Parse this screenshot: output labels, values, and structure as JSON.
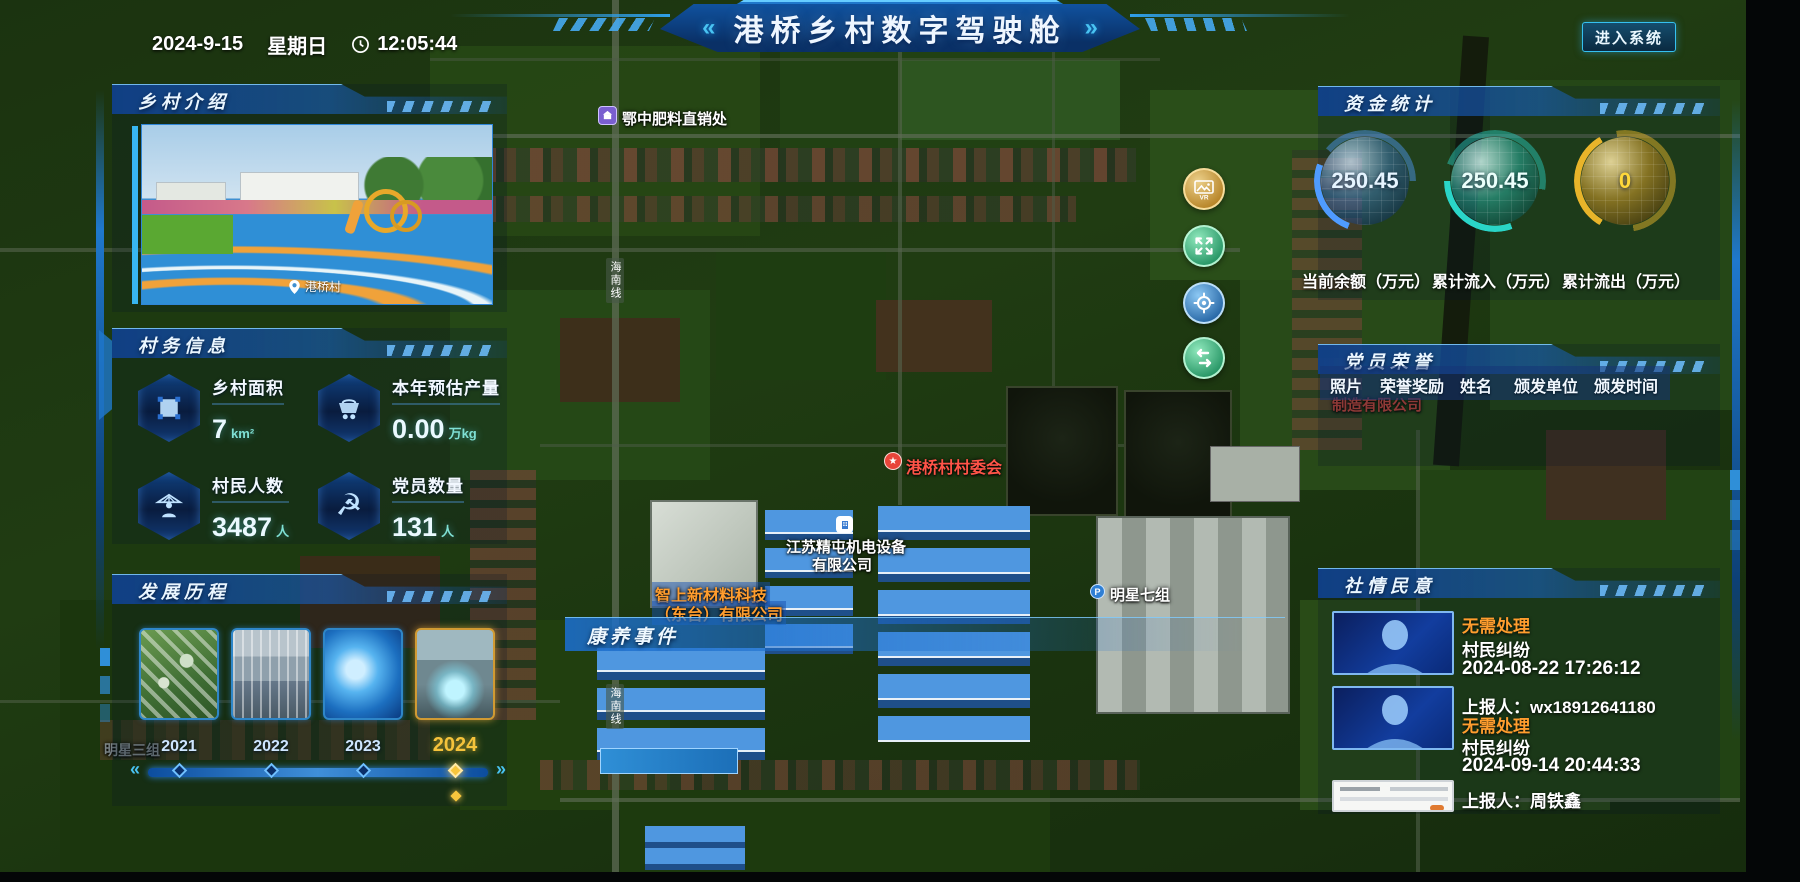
{
  "header": {
    "title": "港桥乡村数字驾驶舱",
    "left_quote": "«",
    "right_quote": "»",
    "date": "2024-9-15",
    "weekday": "星期日",
    "time": "12:05:44",
    "enter_button": "进入系统"
  },
  "panels": {
    "village_intro": {
      "title": "乡村介绍",
      "photo_caption": "港桥村"
    },
    "village_info": {
      "title": "村务信息",
      "stats": [
        {
          "icon": "area-icon",
          "label": "乡村面积",
          "value": "7",
          "unit": "km²"
        },
        {
          "icon": "cart-icon",
          "label": "本年预估产量",
          "value": "0.00",
          "unit": "万kg"
        },
        {
          "icon": "farmer-icon",
          "label": "村民人数",
          "value": "3487",
          "unit": "人"
        },
        {
          "icon": "party-icon",
          "label": "党员数量",
          "value": "131",
          "unit": "人"
        }
      ]
    },
    "development": {
      "title": "发展历程",
      "years": [
        "2021",
        "2022",
        "2023",
        "2024"
      ],
      "active_year": "2024",
      "slider_left_arrow": "«",
      "slider_right_arrow": "»"
    },
    "funds": {
      "title": "资金统计",
      "gauges": [
        {
          "value": "250.45",
          "label": "当前余额（万元）",
          "color": "#4f9bff"
        },
        {
          "value": "250.45",
          "label": "累计流入（万元）",
          "color": "#2ad5c8"
        },
        {
          "value": "0",
          "label": "累计流出（万元）",
          "color": "#e8b42a"
        }
      ]
    },
    "party_honor": {
      "title": "党员荣誉",
      "columns": [
        "照片",
        "荣誉奖励",
        "姓名",
        "颁发单位",
        "颁发时间"
      ]
    },
    "public_opinion": {
      "title": "社情民意",
      "items": [
        {
          "status": "无需处理",
          "type": "村民纠纷",
          "datetime": "2024-08-22 17:26:12",
          "reporter": "上报人：wx18912641180"
        },
        {
          "status": "无需处理",
          "type": "村民纠纷",
          "datetime": "2024-09-14 20:44:33",
          "reporter": "上报人：周铁鑫"
        }
      ]
    }
  },
  "map": {
    "event_title": "康养事件",
    "labels": {
      "fertilizer": "鄂中肥料直销处",
      "committee": "港桥村村委会",
      "company1_line1": "江苏精屯机电设备",
      "company1_line2": "有限公司",
      "company2_line1": "智上新材料科技",
      "company2_line2": "（东台）有限公司",
      "group7": "明星七组",
      "group3": "明星三组",
      "manufacture": "制造有限公司",
      "road": "海南线"
    },
    "controls": [
      "vr-view",
      "fullscreen",
      "locate",
      "layer-switch"
    ]
  },
  "colors": {
    "accent": "#35c1f0",
    "gauge_blue": "#4f9bff",
    "gauge_teal": "#2ad5c8",
    "gauge_gold": "#e8b42a",
    "status_orange": "#ff9d2e",
    "active_year_gold": "#f5c33b",
    "committee_red": "#ff5448",
    "company_orange": "#ff9d2e"
  }
}
